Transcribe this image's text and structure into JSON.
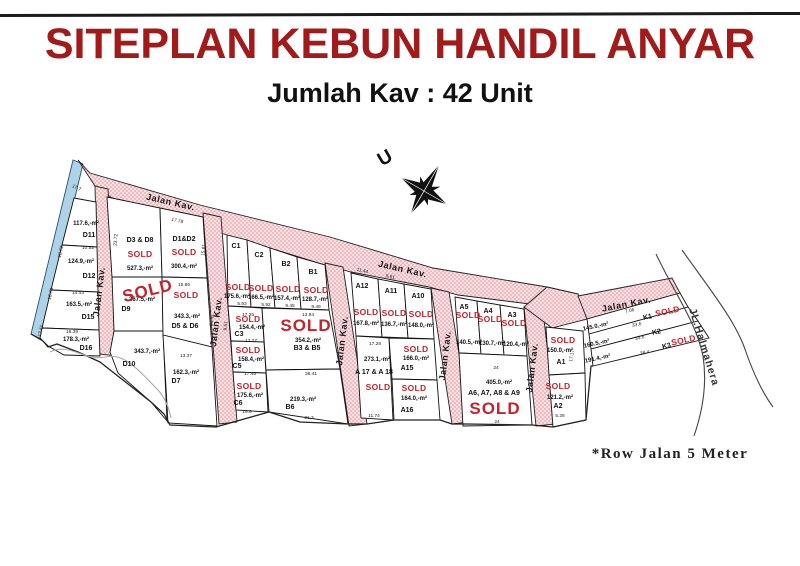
{
  "header": {
    "title": "SITEPLAN KEBUN HANDIL ANYAR",
    "subtitle": "Jumlah Kav : 42 Unit"
  },
  "note": "*Row Jalan 5 Meter",
  "colors": {
    "title_red": "#a21b1b",
    "sold_red": "#c5232e",
    "road_pink": "#f7dde0",
    "road_dot": "#e republic",
    "canal_blue": "#aed3e6"
  },
  "map": {
    "sold_label": "SOLD",
    "road_name": "Jalan Kav.",
    "street": {
      "text": "JL.Halmahera",
      "x": 701,
      "y": 348,
      "r": 73
    },
    "compass": {
      "label": "U",
      "x": 388,
      "y": 163,
      "r": -30
    },
    "plots": [
      {
        "id": "D11",
        "ix": 89,
        "iy": 237,
        "area": "117.6,-m²",
        "ax": 86,
        "ay": 225
      },
      {
        "id": "D12",
        "ix": 89,
        "iy": 278,
        "area": "124.9,-m²",
        "ax": 81,
        "ay": 263
      },
      {
        "id": "D15",
        "ix": 88,
        "iy": 319,
        "area": "163.5,-m²",
        "ax": 79,
        "ay": 306
      },
      {
        "id": "D16",
        "ix": 86,
        "iy": 350,
        "area": "178.3,-m²",
        "ax": 76,
        "ay": 341
      },
      {
        "id": "D3 & D8",
        "ix": 140,
        "iy": 242,
        "area": "527.3,-m²",
        "ax": 140,
        "ay": 270,
        "sold": true,
        "sx": 140,
        "sy": 257
      },
      {
        "id": "D9",
        "ix": 126,
        "iy": 311,
        "area": "367.5,-m²",
        "ax": 142,
        "ay": 301,
        "sold": true,
        "big": true,
        "sx": 149,
        "sy": 296,
        "srot": -14
      },
      {
        "id": "D10",
        "ix": 129,
        "iy": 366,
        "area": "343.7,-m²",
        "ax": 147,
        "ay": 353
      },
      {
        "id": "D1&D2",
        "ix": 184,
        "iy": 241,
        "area": "300.4,-m²",
        "ax": 184,
        "ay": 268,
        "sold": true,
        "sx": 184,
        "sy": 255
      },
      {
        "id": "D5 & D6",
        "ix": 185,
        "iy": 328,
        "area": "343.3,-m²",
        "ax": 187,
        "ay": 318,
        "sold": true,
        "sx": 186,
        "sy": 298
      },
      {
        "id": "D7",
        "ix": 176,
        "iy": 383,
        "area": "162.3,-m²",
        "ax": 186,
        "ay": 374
      },
      {
        "id": "C1",
        "ix": 236,
        "iy": 248,
        "area": "175.6,-m²",
        "ax": 237,
        "ay": 298,
        "sold": true,
        "sx": 238,
        "sy": 290
      },
      {
        "id": "C2",
        "ix": 259,
        "iy": 257,
        "area": "166.5,-m²",
        "ax": 261,
        "ay": 299,
        "sold": true,
        "sx": 261,
        "sy": 291
      },
      {
        "id": "B2",
        "ix": 286,
        "iy": 266,
        "area": "157.4,-m²",
        "ax": 287,
        "ay": 300,
        "sold": true,
        "sx": 288,
        "sy": 292
      },
      {
        "id": "B1",
        "ix": 313,
        "iy": 274,
        "area": "128.7,-m²",
        "ax": 315,
        "ay": 301,
        "sold": true,
        "sx": 316,
        "sy": 293
      },
      {
        "id": "C3",
        "ix": 239,
        "iy": 336,
        "area": "154.4,-m²",
        "ax": 252,
        "ay": 329,
        "sold": true,
        "sx": 248,
        "sy": 322
      },
      {
        "id": "C5",
        "ix": 237,
        "iy": 368,
        "area": "158.4,-m²",
        "ax": 251,
        "ay": 361,
        "sold": true,
        "sx": 248,
        "sy": 353
      },
      {
        "id": "C6",
        "ix": 238,
        "iy": 405,
        "area": "175.6,-m²",
        "ax": 250,
        "ay": 397,
        "sold": true,
        "sx": 249,
        "sy": 389
      },
      {
        "id": "B3 & B5",
        "ix": 307,
        "iy": 350,
        "area": "354.2,-m²",
        "ax": 308,
        "ay": 342,
        "sold": true,
        "big": true,
        "sx": 306,
        "sy": 331
      },
      {
        "id": "B6",
        "ix": 290,
        "iy": 409,
        "area": "219.3,-m²",
        "ax": 303,
        "ay": 401
      },
      {
        "id": "A12",
        "ix": 362,
        "iy": 288,
        "area": "167.8,-m²",
        "ax": 366,
        "ay": 325,
        "sold": true,
        "sx": 366,
        "sy": 315
      },
      {
        "id": "A11",
        "ix": 391,
        "iy": 293,
        "area": "136.7,-m²",
        "ax": 394,
        "ay": 326,
        "sold": true,
        "sx": 394,
        "sy": 316
      },
      {
        "id": "A10",
        "ix": 418,
        "iy": 298,
        "area": "148.0,-m²",
        "ax": 421,
        "ay": 327,
        "sold": true,
        "sx": 421,
        "sy": 317
      },
      {
        "id": "A 17 & A 18",
        "ix": 374,
        "iy": 374,
        "area": "273.1,-m²",
        "ax": 377,
        "ay": 361,
        "sold": true,
        "sx": 378,
        "sy": 390
      },
      {
        "id": "A15",
        "ix": 407,
        "iy": 370,
        "area": "166.0,-m²",
        "ax": 416,
        "ay": 360,
        "sold": true,
        "sx": 416,
        "sy": 352
      },
      {
        "id": "A16",
        "ix": 407,
        "iy": 412,
        "area": "164.0,-m²",
        "ax": 414,
        "ay": 400,
        "sold": true,
        "sx": 414,
        "sy": 391
      },
      {
        "id": "A5",
        "ix": 464,
        "iy": 309,
        "area": "140.5,-m²",
        "ax": 469,
        "ay": 344,
        "sold": true,
        "sx": 468,
        "sy": 318
      },
      {
        "id": "A4",
        "ix": 488,
        "iy": 313,
        "area": "130.7,-m²",
        "ax": 492,
        "ay": 345,
        "sold": true,
        "sx": 490,
        "sy": 322
      },
      {
        "id": "A3",
        "ix": 512,
        "iy": 317,
        "area": "120.4,-m²",
        "ax": 516,
        "ay": 346,
        "sold": true,
        "sx": 514,
        "sy": 326
      },
      {
        "id": "A6, A7, A8 & A9",
        "ix": 494,
        "iy": 395,
        "area": "405.0,-m²",
        "ax": 499,
        "ay": 384,
        "sold": true,
        "big": true,
        "sx": 495,
        "sy": 414
      },
      {
        "id": "A1",
        "ix": 561,
        "iy": 364,
        "area": "150.0,-m²",
        "ax": 560,
        "ay": 352,
        "sold": true,
        "sx": 563,
        "sy": 343
      },
      {
        "id": "A2",
        "ix": 558,
        "iy": 408,
        "area": "121.2,-m²",
        "ax": 560,
        "ay": 399,
        "sold": true,
        "sx": 558,
        "sy": 389
      },
      {
        "id": "K1",
        "ix": 648,
        "iy": 319,
        "rot": -12,
        "area": "145.0,-m²",
        "ax": 596,
        "ay": 328,
        "sold": true,
        "sx": 668,
        "sy": 314
      },
      {
        "id": "K2",
        "ix": 657,
        "iy": 334,
        "rot": -12,
        "area": "160.5,-m²",
        "ax": 597,
        "ay": 345
      },
      {
        "id": "K3",
        "ix": 667,
        "iy": 348,
        "rot": -12,
        "area": "191.4,-m²",
        "ax": 598,
        "ay": 360,
        "sold": true,
        "sx": 684,
        "sy": 343
      }
    ],
    "road_labels": [
      {
        "x": 170,
        "y": 205,
        "r": 13
      },
      {
        "x": 402,
        "y": 272,
        "r": 13
      },
      {
        "x": 102,
        "y": 292,
        "r": -83
      },
      {
        "x": 219,
        "y": 322,
        "r": -83
      },
      {
        "x": 345,
        "y": 341,
        "r": -83
      },
      {
        "x": 448,
        "y": 356,
        "r": -83
      },
      {
        "x": 535,
        "y": 368,
        "r": -83
      },
      {
        "x": 627,
        "y": 307,
        "r": -11
      }
    ],
    "dims": [
      {
        "t": "10.52",
        "x": 88,
        "y": 249
      },
      {
        "t": "14.43",
        "x": 78,
        "y": 294
      },
      {
        "t": "16.39",
        "x": 72,
        "y": 333
      },
      {
        "t": "17.7",
        "x": 76,
        "y": 189,
        "r": 25
      },
      {
        "t": "10.72",
        "x": 62,
        "y": 252,
        "r": -78
      },
      {
        "t": "10.73",
        "x": 52,
        "y": 294,
        "r": -78
      },
      {
        "t": "13.41",
        "x": 42,
        "y": 331,
        "r": -78
      },
      {
        "t": "23.72",
        "x": 117,
        "y": 240,
        "r": -85
      },
      {
        "t": "17.78",
        "x": 177,
        "y": 222,
        "r": 13
      },
      {
        "t": "15.86",
        "x": 184,
        "y": 286
      },
      {
        "t": "13.37",
        "x": 186,
        "y": 357
      },
      {
        "t": "15.81",
        "x": 205,
        "y": 250,
        "r": -85
      },
      {
        "t": "21.91",
        "x": 213,
        "y": 320,
        "r": -85
      },
      {
        "t": "9.51",
        "x": 227,
        "y": 326,
        "r": -85
      },
      {
        "t": "17.25",
        "x": 248,
        "y": 316
      },
      {
        "t": "17.27",
        "x": 251,
        "y": 342
      },
      {
        "t": "17.46",
        "x": 250,
        "y": 375
      },
      {
        "t": "16.6",
        "x": 247,
        "y": 413
      },
      {
        "t": "13.94",
        "x": 308,
        "y": 316
      },
      {
        "t": "36.41",
        "x": 311,
        "y": 375
      },
      {
        "t": "21.3",
        "x": 309,
        "y": 419
      },
      {
        "t": "5.93",
        "x": 242,
        "y": 305
      },
      {
        "t": "5.92",
        "x": 266,
        "y": 306
      },
      {
        "t": "9.45",
        "x": 290,
        "y": 307
      },
      {
        "t": "9.49",
        "x": 316,
        "y": 308
      },
      {
        "t": "11.44",
        "x": 362,
        "y": 272,
        "r": 13
      },
      {
        "t": "5.61",
        "x": 390,
        "y": 278,
        "r": 13
      },
      {
        "t": "17.28",
        "x": 375,
        "y": 345
      },
      {
        "t": "11.74",
        "x": 374,
        "y": 417
      },
      {
        "t": "24",
        "x": 496,
        "y": 369
      },
      {
        "t": "24",
        "x": 497,
        "y": 423
      },
      {
        "t": "17.17",
        "x": 573,
        "y": 356,
        "r": -80
      },
      {
        "t": "5.28",
        "x": 560,
        "y": 417
      },
      {
        "t": "7.06",
        "x": 630,
        "y": 312,
        "r": -12
      },
      {
        "t": "33.6",
        "x": 637,
        "y": 326,
        "r": -12
      },
      {
        "t": "33.6",
        "x": 640,
        "y": 339,
        "r": -12
      },
      {
        "t": "38.4",
        "x": 645,
        "y": 354,
        "r": -12
      }
    ]
  }
}
